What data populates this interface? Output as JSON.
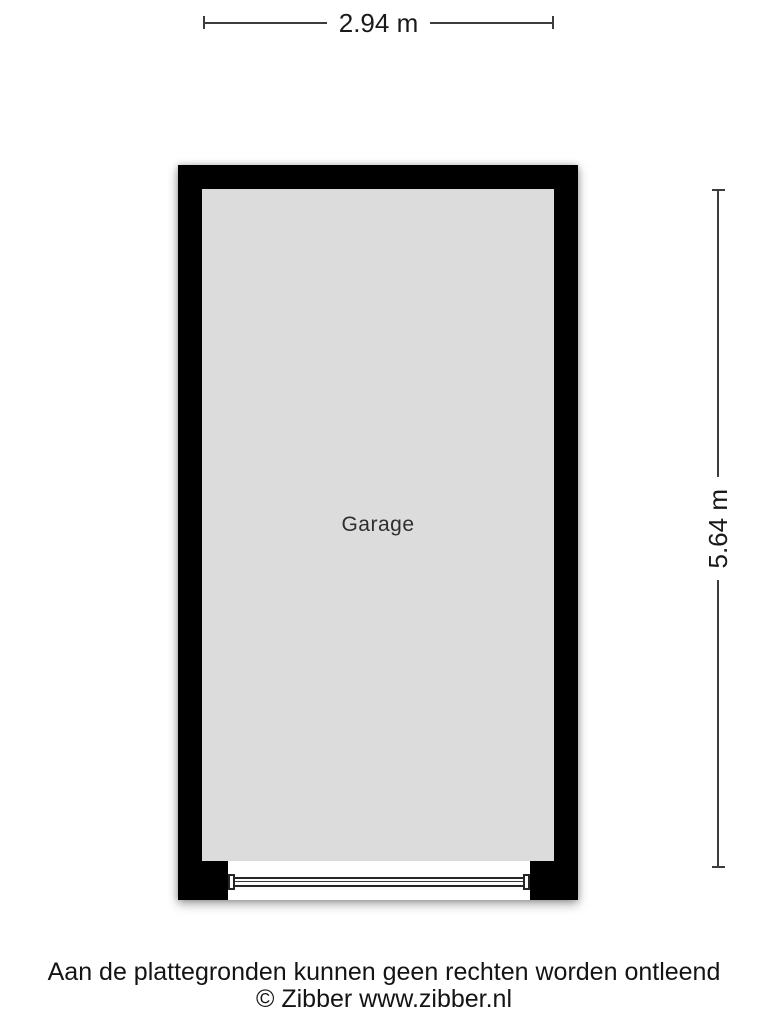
{
  "floorplan": {
    "room_label": "Garage",
    "width_label": "2.94 m",
    "height_label": "5.64 m"
  },
  "footer": {
    "disclaimer": "Aan de plattegronden kunnen geen rechten worden ontleend",
    "copyright": "© Zibber www.zibber.nl"
  },
  "colors": {
    "background": "#ffffff",
    "wall": "#000000",
    "room_fill": "#dcdcdc",
    "dimension_line": "#3c3c3c",
    "text": "#1a1a1a"
  }
}
